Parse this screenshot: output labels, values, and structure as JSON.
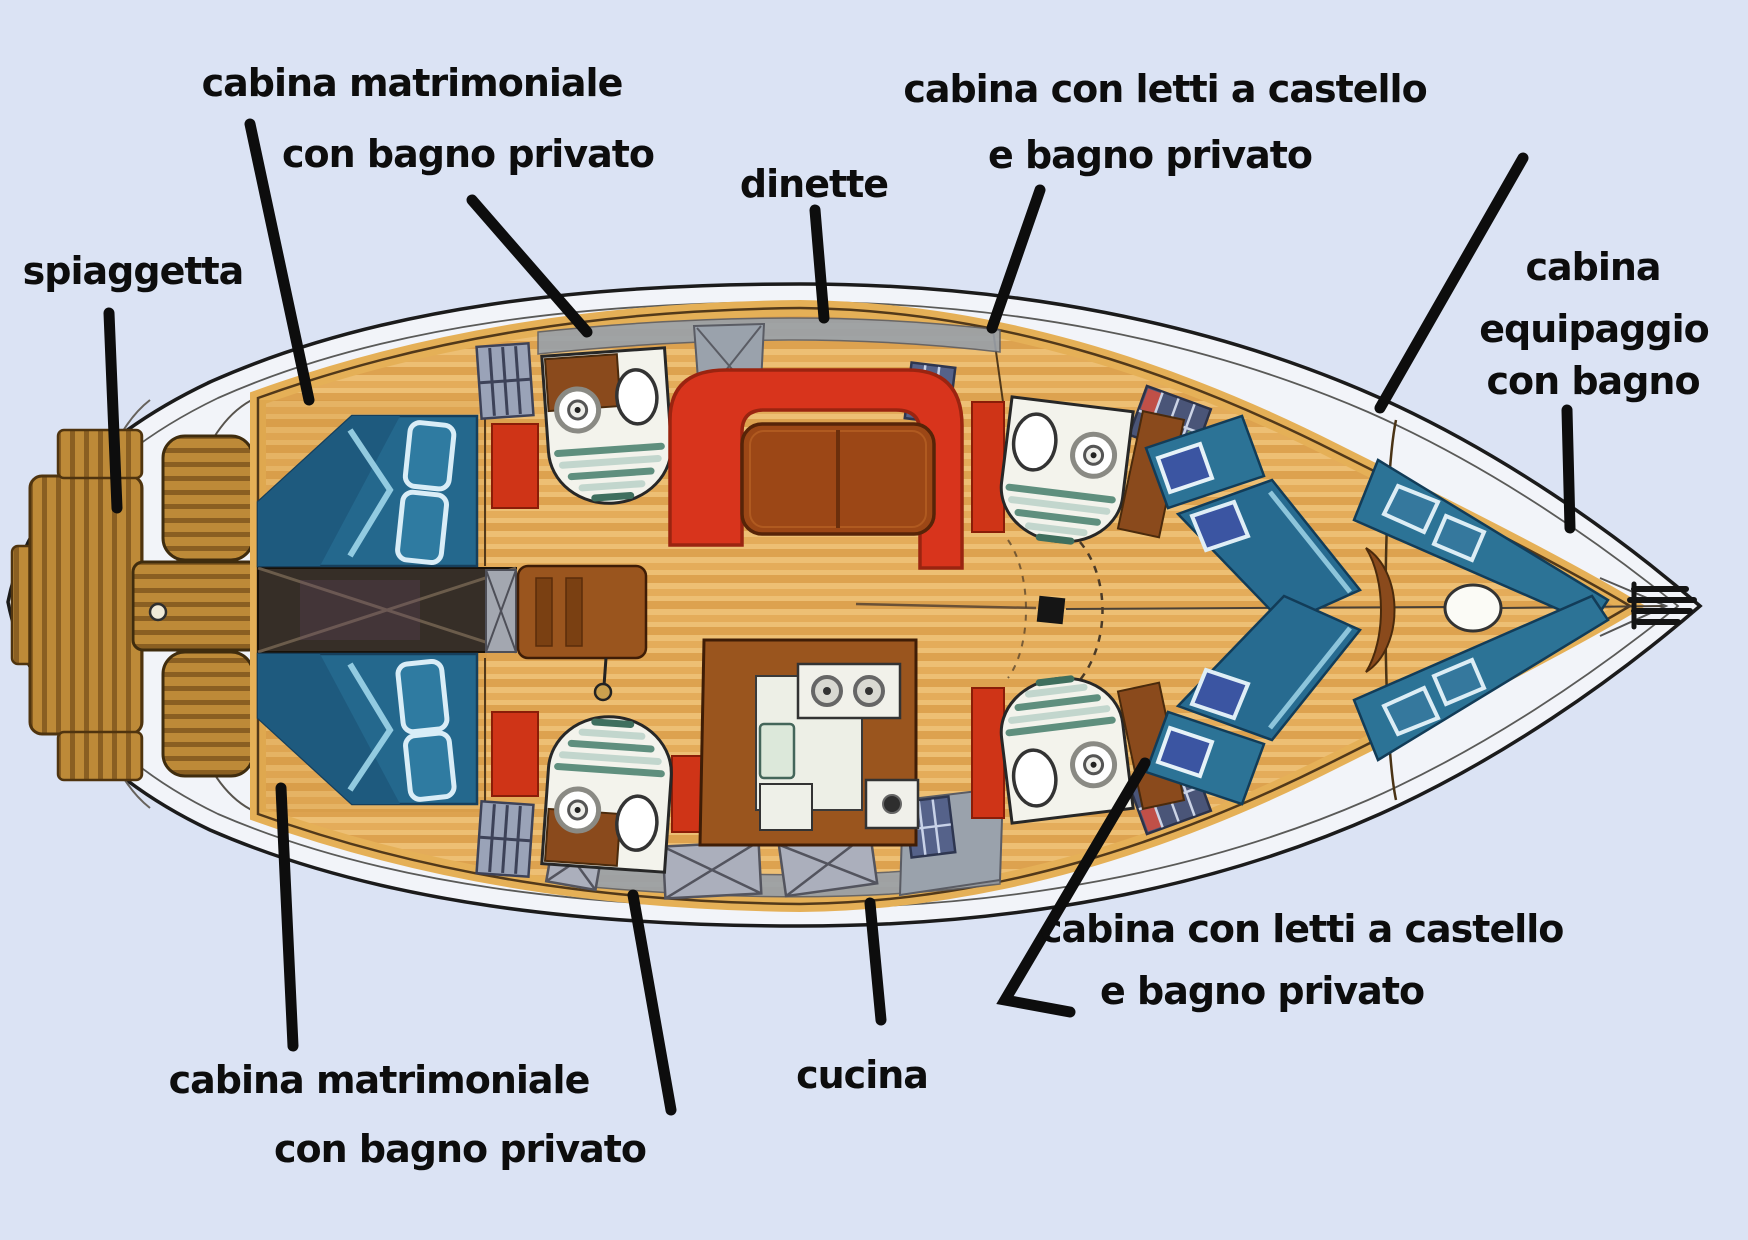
{
  "title": "pianta barca a vela con cabine annotate",
  "labels": {
    "spiaggetta": "spiaggetta",
    "matrimoniale_top_1": "cabina matrimoniale",
    "matrimoniale_top_2": "con bagno privato",
    "dinette": "dinette",
    "bunk_top_1": "cabina con letti a castello",
    "bunk_top_2": "e bagno privato",
    "crew_1": "cabina",
    "crew_2": "equipaggio",
    "crew_3": "con bagno",
    "matrimoniale_bottom_1": "cabina matrimoniale",
    "matrimoniale_bottom_2": "con bagno privato",
    "cucina": "cucina",
    "bunk_bottom_1": "cabina con letti a castello",
    "bunk_bottom_2": "e bagno privato"
  },
  "colors": {
    "background": "#dbe3f4",
    "hull_fill": "#f2f4f9",
    "outline": "#1b1b1b",
    "wood_floor_light": "#edbf74",
    "wood_floor_dark": "#dda24f",
    "deck_wood": "#bd8a38",
    "bed_teal": "#2c7396",
    "bed_trim_lightblue": "#a8dcee",
    "pillow_indigo": "#3b55a2",
    "sofa_red": "#d8341c",
    "table_brown": "#9c4716",
    "cabinet_brown": "#8a4a1c",
    "corridor_dark": "#362e27",
    "bathroom_white": "#f3f3ec",
    "shower_green": "#5f8f7e",
    "hatch_gray": "#9aa2ac",
    "locker_red": "#cf3417",
    "label_text": "#0d0d0d",
    "leader_line": "#0d0d0d"
  }
}
